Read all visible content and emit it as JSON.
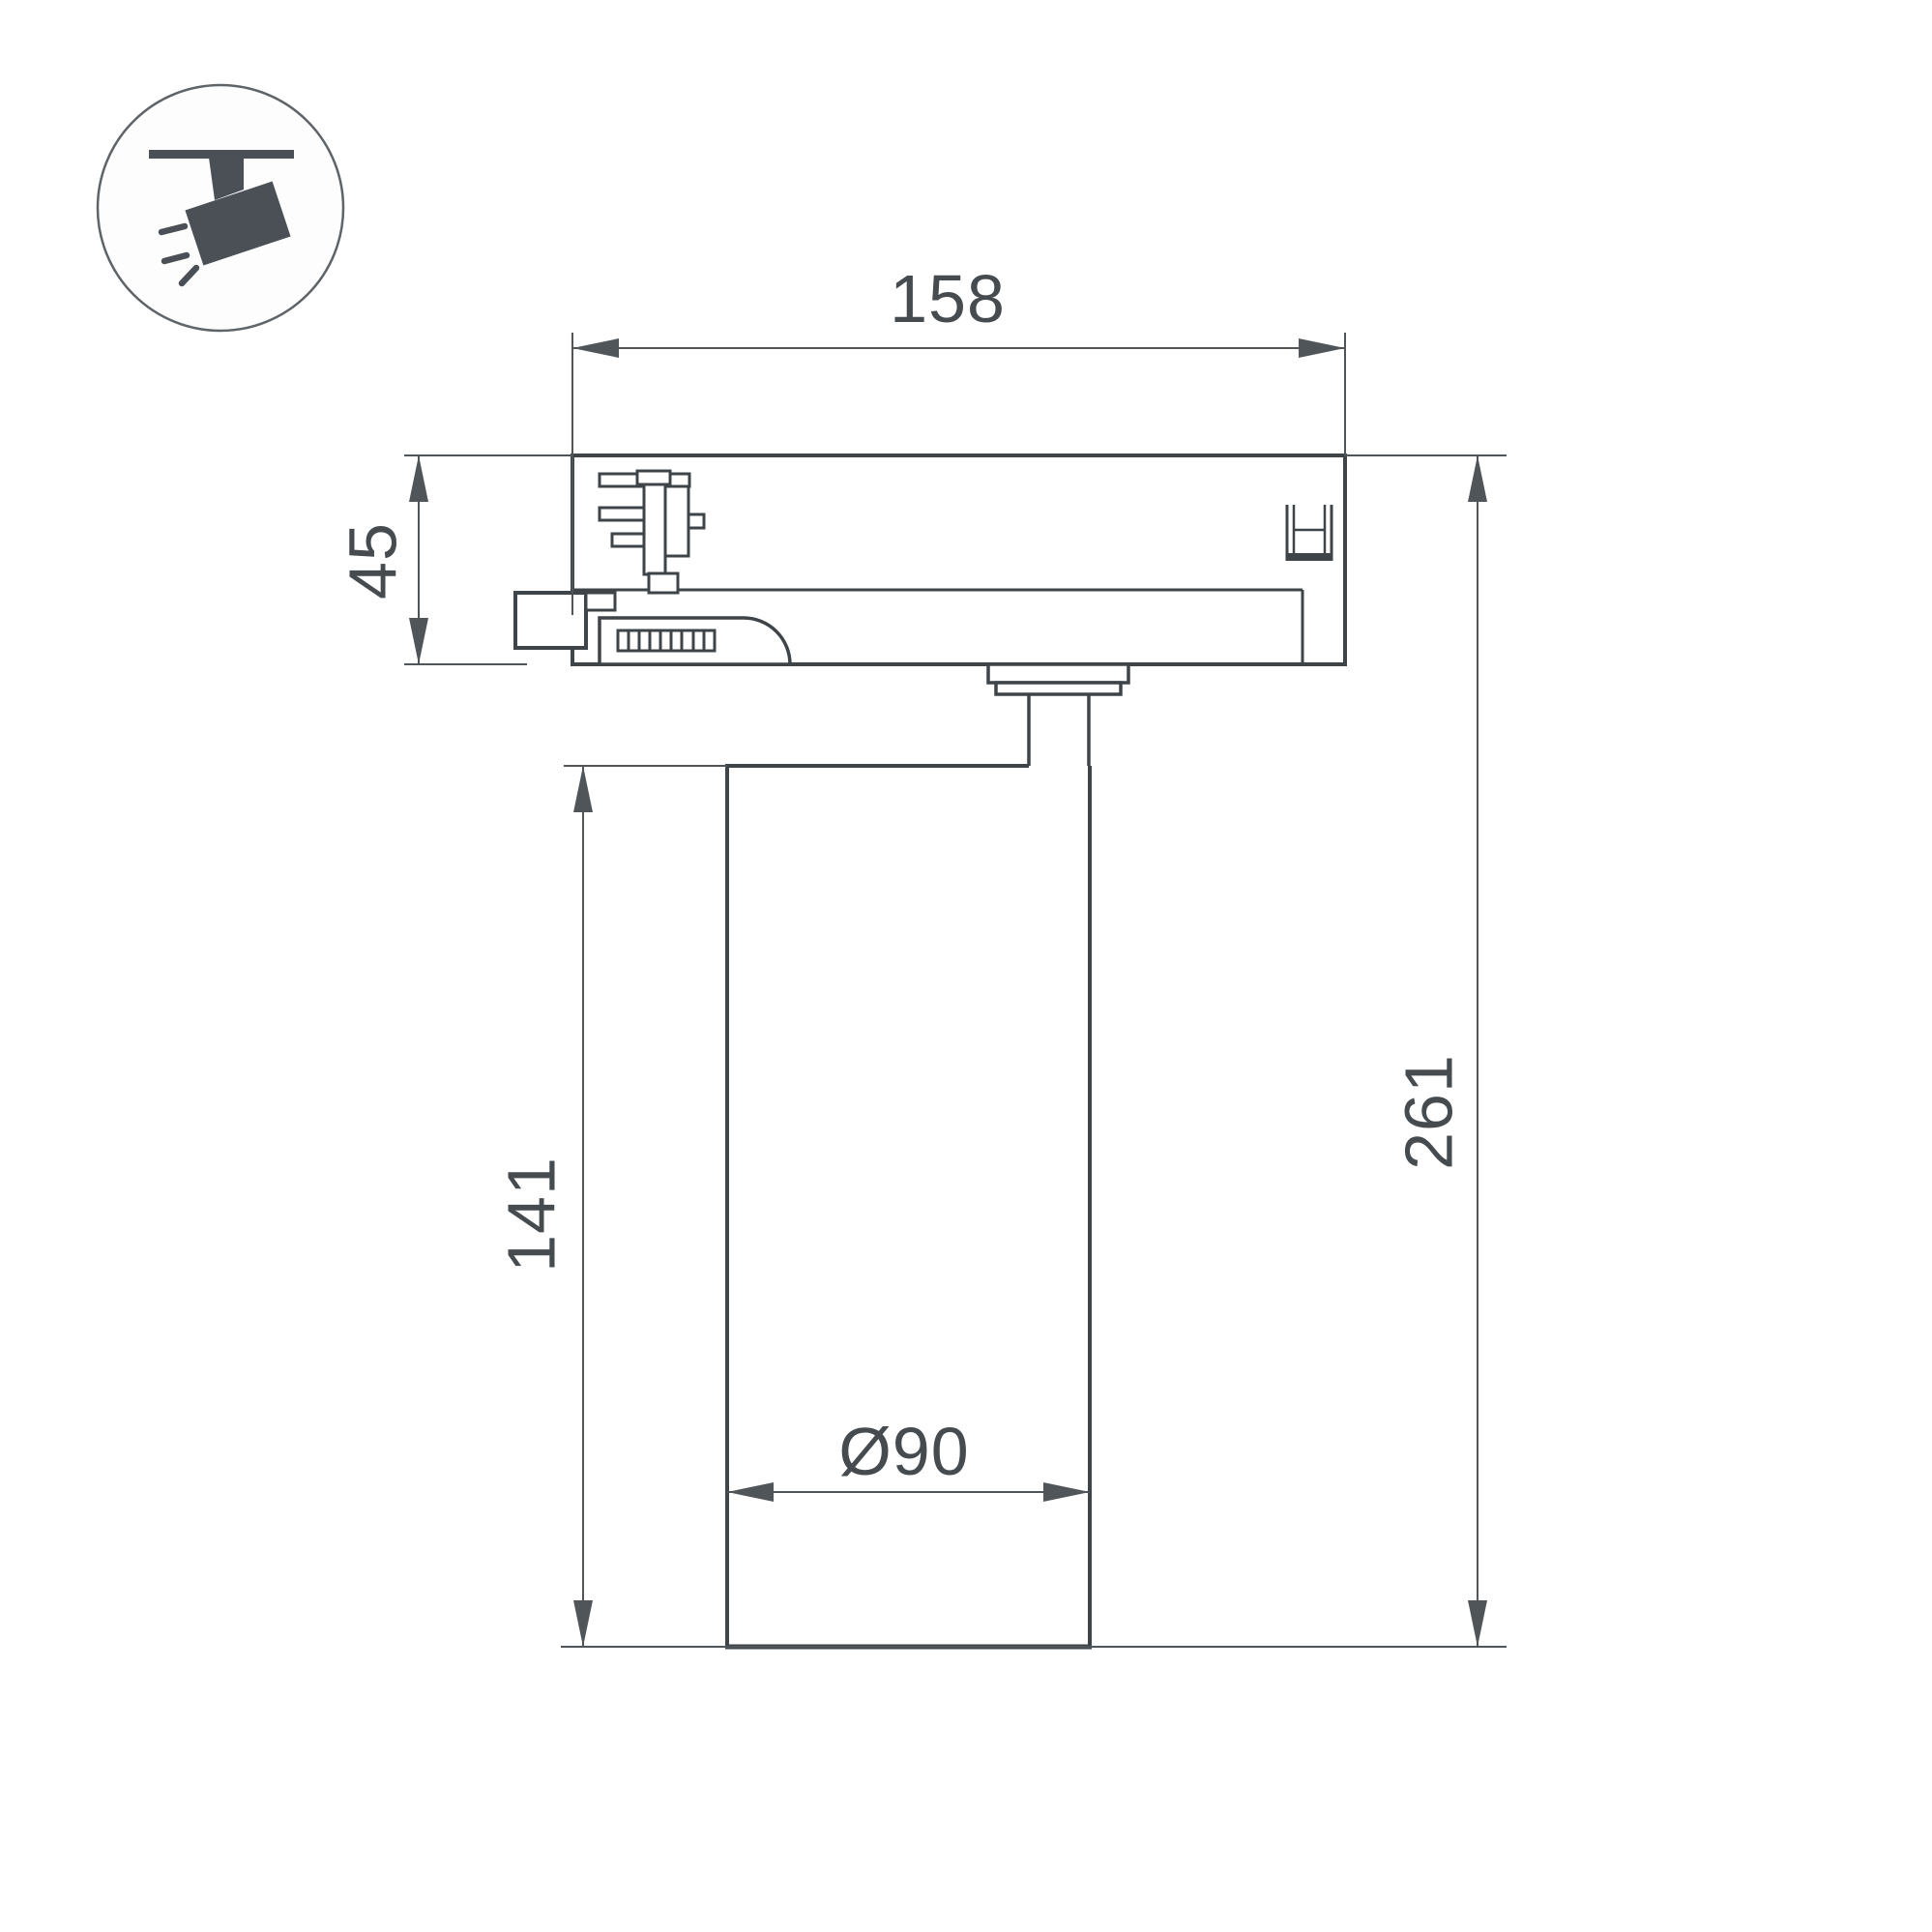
{
  "page": {
    "background": "#ffffff",
    "kind": "technical dimensional drawing of a track-mounted spotlight"
  },
  "legend": {
    "icon": "ceiling-track-spotlight-icon",
    "icon_color": "#4a5056",
    "circle_stroke": "#5f6468"
  },
  "drawing": {
    "line_color": "#3f4449",
    "dim_color": "#50555a",
    "text_color": "#464b50",
    "labels": {
      "track_adapter_width": "158",
      "track_adapter_height": "45",
      "lamp_body_height": "141",
      "total_height": "261",
      "lamp_body_diameter": "Ø90"
    }
  }
}
